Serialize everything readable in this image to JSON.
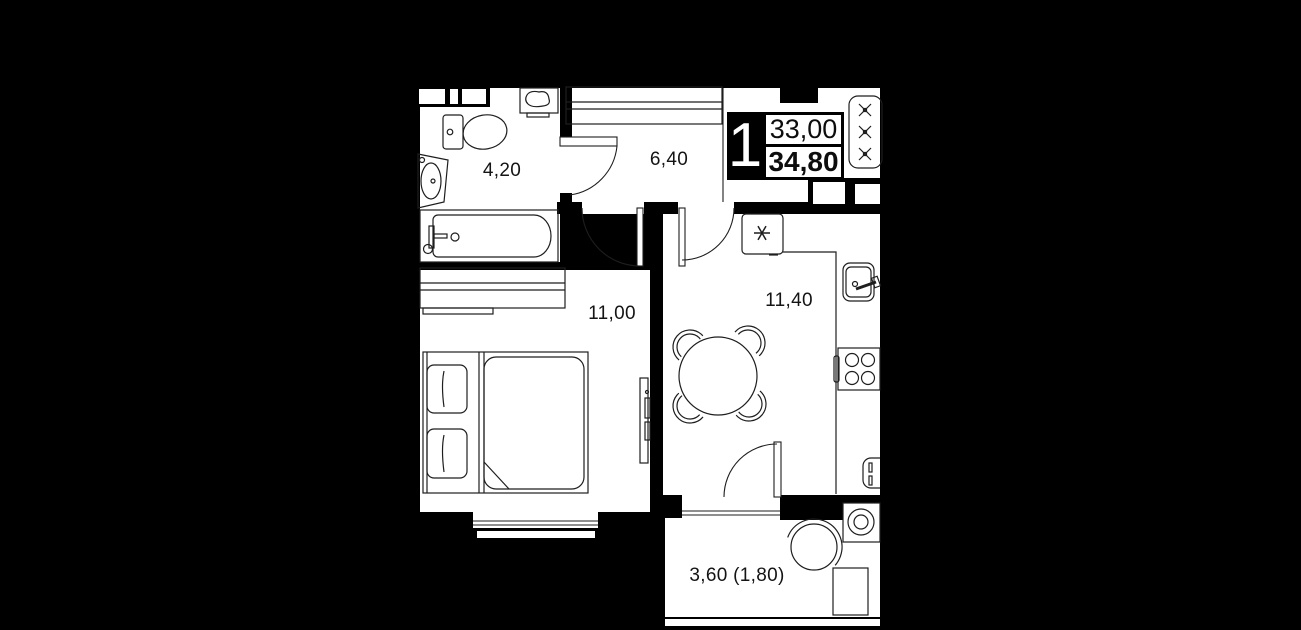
{
  "unit_badge": {
    "rooms_count": "1",
    "area_total": "33,00",
    "area_reduced": "34,80"
  },
  "room_labels": {
    "bathroom": "4,20",
    "hallway": "6,40",
    "bedroom": "11,00",
    "kitchen_living": "11,40",
    "balcony": "3,60 (1,80)"
  },
  "icons": {
    "fridge": "snowflake-icon",
    "ventilation_shaft": "x-cross-icon"
  },
  "colors": {
    "background": "#000000",
    "floor": "#ffffff",
    "line": "#1e1e1e"
  }
}
